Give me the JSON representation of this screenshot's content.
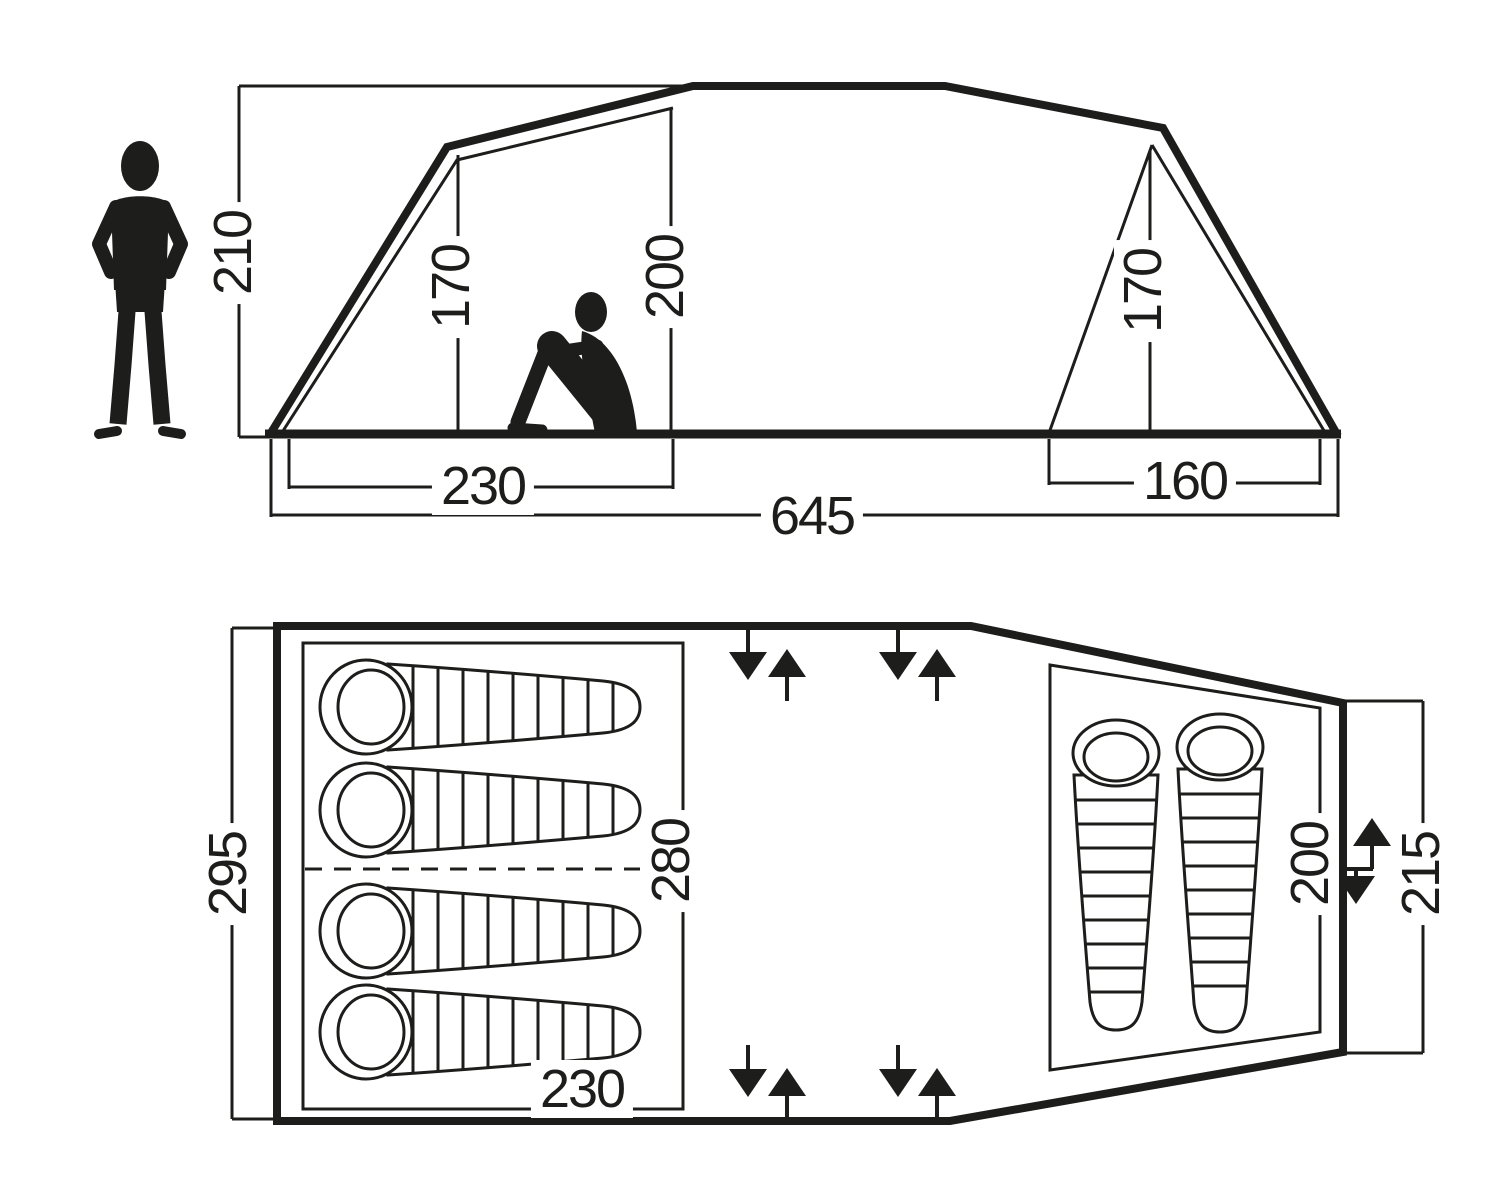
{
  "diagram": {
    "type": "tent-dimension-drawing",
    "line_color": "#1d1d1b",
    "background_color": "#ffffff",
    "side_view": {
      "total_height": "210",
      "left_room_height": "170",
      "inner_height": "200",
      "right_room_height": "170",
      "left_room_width": "230",
      "right_room_width": "160",
      "total_length": "645"
    },
    "floor_plan": {
      "total_width": "295",
      "inner_width": "280",
      "left_room_length": "230",
      "right_room_length": "200",
      "rear_wall_width": "215",
      "left_room_sleeping_bags": 4,
      "right_room_sleeping_bags": 2,
      "entrance_arrow_pairs_top": 2,
      "entrance_arrow_pairs_bottom": 2,
      "entrance_arrow_pairs_right": 1
    }
  }
}
